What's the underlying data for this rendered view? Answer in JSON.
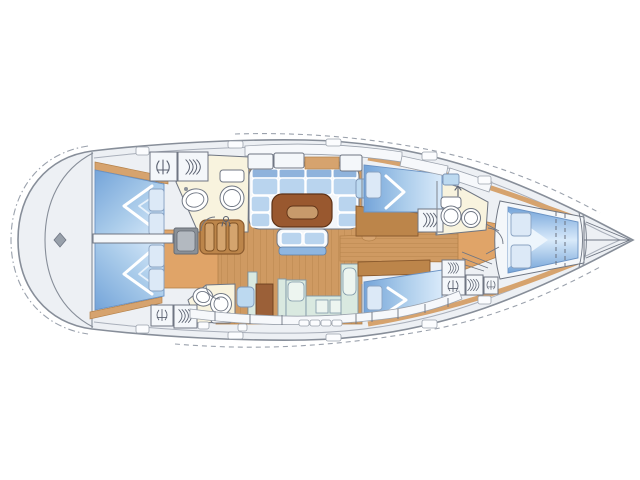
{
  "description": "Top-view interior layout plan of a sailing yacht (no text labels in drawing)",
  "figure": {
    "width": 640,
    "height": 480
  },
  "palette": {
    "page_bg": "#ffffff",
    "hull_fill": "#edf0f4",
    "hull_line": "#878e99",
    "inner_line": "#a9afba",
    "dash_line": "#9aa1ac",
    "outline": "#5d6470",
    "room_white": "#f4f7fa",
    "cream": "#f8f3de",
    "wood": "#cf9a62",
    "wood_line": "#b5824a",
    "floor_orange": "#e0a468",
    "trim": "#d6a36e",
    "cabinet": "#bc854a",
    "cabinet_dark": "#9b6038",
    "table": "#99582f",
    "table_inset": "#c79a6b",
    "berth_dark": "#74a4d9",
    "berth_mid": "#a9cbea",
    "berth_light": "#d9eafa",
    "cushion": "#b9d4ee",
    "cushion_back": "#8fb3dc",
    "pillow": "#dce9f7",
    "window_blue": "#bcd9f0",
    "mint": "#d9e9e0",
    "mint_inner": "#edf5f0",
    "gray_box": "#8a9097",
    "gray_box_inner": "#b3b9c0",
    "steps_tread": "#d4a46e",
    "steps_frame": "#8a5a2e",
    "icon": "#5a6170",
    "fixture_line": "#6f7683"
  },
  "regions": [
    {
      "id": "stern-deck",
      "label": "stern deck"
    },
    {
      "id": "port-aft-cabin",
      "label": "aft double cabin (top)"
    },
    {
      "id": "starboard-aft-cabin",
      "label": "aft double cabin (bottom)"
    },
    {
      "id": "port-aft-head",
      "label": "aft head with toilet and sink (top)"
    },
    {
      "id": "starboard-aft-head",
      "label": "aft head with toilet and sink (bottom)"
    },
    {
      "id": "companionway-steps",
      "label": "companionway steps"
    },
    {
      "id": "engine-compartment",
      "label": "engine box"
    },
    {
      "id": "saloon-dinette",
      "label": "U-shaped settee"
    },
    {
      "id": "saloon-table",
      "label": "saloon table"
    },
    {
      "id": "saloon-bench",
      "label": "centerline bench"
    },
    {
      "id": "galley",
      "label": "galley counters"
    },
    {
      "id": "sideboard",
      "label": "sideboard cabinet"
    },
    {
      "id": "port-mid-cabin",
      "label": "mid cabin berth (top)"
    },
    {
      "id": "starboard-mid-cabin",
      "label": "mid cabin berth (bottom)"
    },
    {
      "id": "corridor",
      "label": "central corridor"
    },
    {
      "id": "mast",
      "label": "mast post"
    },
    {
      "id": "forward-head",
      "label": "forward head"
    },
    {
      "id": "forward-cabin",
      "label": "forward cabin with V-berth"
    },
    {
      "id": "bow-locker",
      "label": "anchor locker / bow"
    }
  ]
}
